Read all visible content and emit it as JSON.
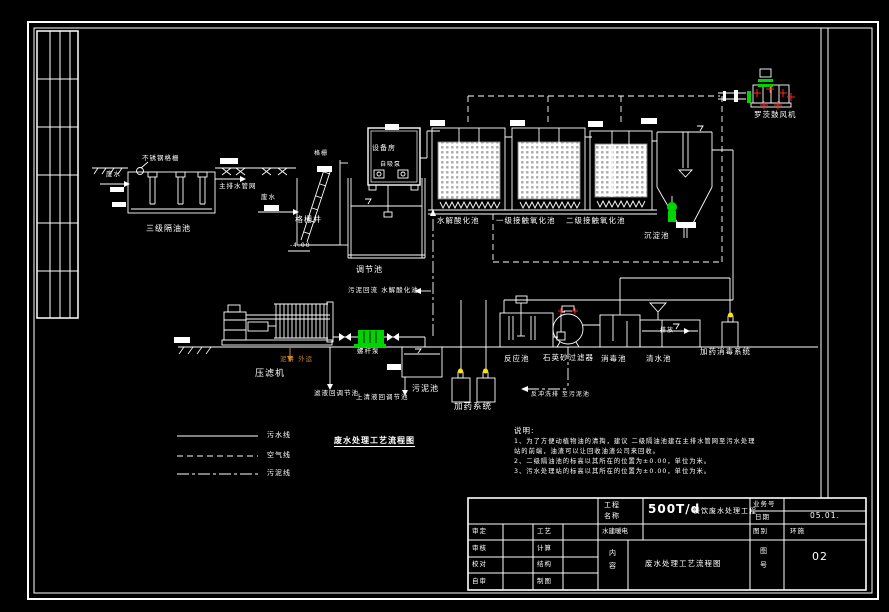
{
  "colors": {
    "background": "#000000",
    "line": "#ffffff",
    "media_gray": "#a8a8a8",
    "pump_green": "#00d400",
    "mark_red": "#ff2222",
    "dot_yellow": "#ffe600",
    "cake_orange": "#c8832c"
  },
  "labels": {
    "oil_tank": "三级隔油池",
    "stainless_screen": "不锈钢格栅",
    "wastewater": "废水",
    "main_drain": "主排水管网",
    "screen": "格栅",
    "screen_well": "格栅井",
    "elev_minus4": "-4.00",
    "equipment_room": "设备房",
    "self_priming_pump": "自吸泵",
    "regulating_tank": "调节池",
    "hydrolysis_tank": "水解酸化池",
    "contact_tank_1": "一级接触氧化池",
    "contact_tank_2": "二级接触氧化池",
    "sedimentation_tank": "沉淀池",
    "roots_blower": "罗茨鼓风机",
    "sludge_return": "污泥回流 水解酸化池",
    "filter_press": "压滤机",
    "mud_cake_out": "泥饼 外运",
    "screw_pump": "螺杆泵",
    "filtrate_return": "滤液回调节池",
    "supernatant_return": "上清液回调节池",
    "sludge_tank": "污泥池",
    "dosing_system": "加药系统",
    "reaction_tank": "反应池",
    "quartz_sand_filter": "石英砂过滤器",
    "disinfection_tank": "消毒池",
    "clean_water_tank": "清水池",
    "discharge": "排放",
    "dosing_disinfection_system": "加药消毒系统",
    "backwash_to_sludge": "反冲洗排 至污泥池"
  },
  "legend": {
    "items": [
      {
        "style": "solid",
        "label": "污水线"
      },
      {
        "style": "dashed",
        "label": "空气线"
      },
      {
        "style": "dashdot",
        "label": "污泥线"
      }
    ]
  },
  "diagram_title": "废水处理工艺流程图",
  "notes": {
    "heading": "说明:",
    "line1": "1、为了方便动植物油的清掏，建议 二级隔油池建在主排水管网至污水处理",
    "line2": "站的前端，油渣可以让回收油渣公司来回收。",
    "line3": "2、二级隔油池的标高以其所在的位置为±0.00，单位为米。",
    "line4": "3、污水处理站的标高以其所在的位置为±0.00，单位为米。"
  },
  "title_block": {
    "project_label_line1": "工程",
    "project_label_line2": "名称",
    "project_name_main": "500T/d",
    "project_name_suffix": "餐饮废水处理工程",
    "job_no_label": "业务号",
    "date_label": "日期",
    "date_value": "05.01.",
    "category_label": "图别",
    "category_value": "环施",
    "content_label_line1": "内",
    "content_label_line2": "容",
    "content_value": "废水处理工艺流程图",
    "sheet_label_line1": "图",
    "sheet_label_line2": "号",
    "sheet_value": "02",
    "approver_label": "审定",
    "reviewer_label": "审核",
    "proofread_label": "校对",
    "self_check_label": "自审",
    "process_label": "工艺",
    "calculation_label": "计算",
    "structure_label": "结构",
    "drafting_label": "制图",
    "disciplines_label": "水建暖电"
  }
}
